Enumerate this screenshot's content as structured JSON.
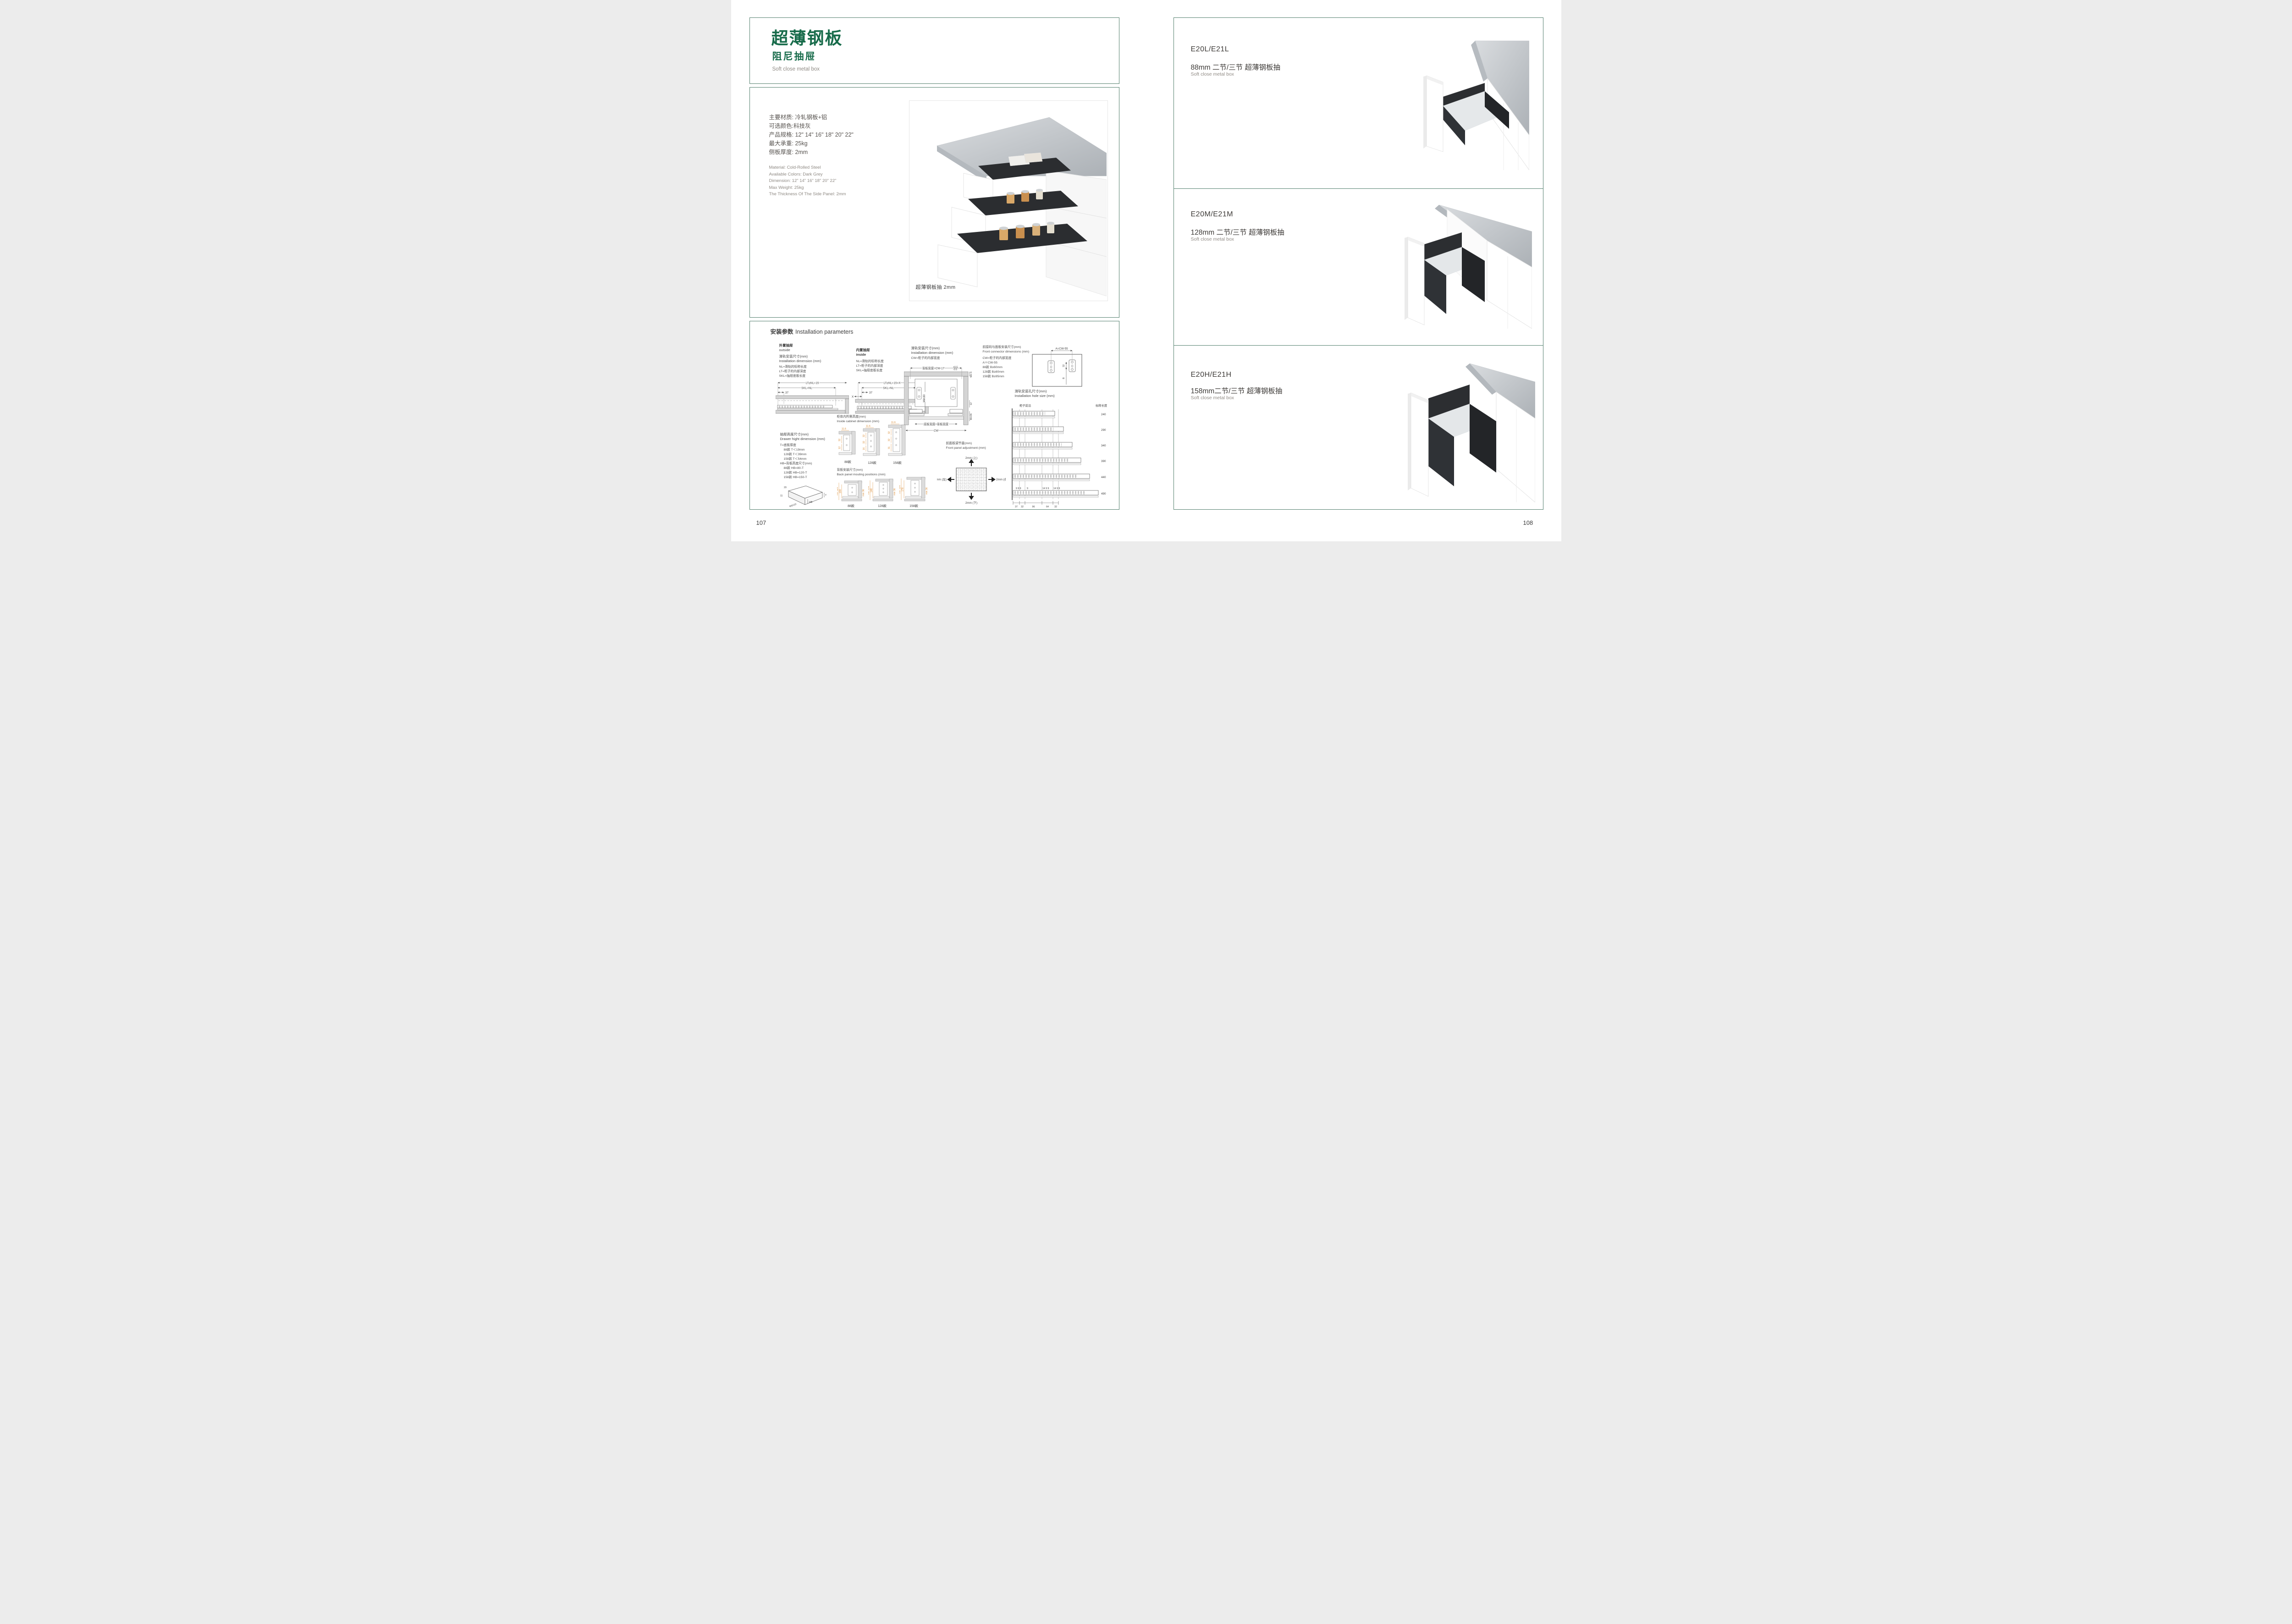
{
  "page": {
    "left_number": "107",
    "right_number": "108"
  },
  "left_page": {
    "title_cn": "超薄钢板",
    "subtitle_cn": "阻尼抽屉",
    "subtitle_en": "Soft close metal box",
    "specs_cn": [
      "主要材质: 冷轧钢板+铝",
      "可选颜色:科技灰",
      "产品规格: 12\" 14\" 16\" 18\" 20\" 22\"",
      "最大承重: 25kg",
      "侧板厚度: 2mm"
    ],
    "specs_en": [
      "Material: Cold-Rolled Steel",
      "Available Colors: Dark Grey",
      "Dimension: 12\" 14\" 16\" 18\" 20\" 22\"",
      "Max Weight: 25kg",
      "The Thickness Of The Side Panel: 2mm"
    ],
    "photo_caption": "超薄钢板抽 2mm"
  },
  "install": {
    "header_cn": "安装参数",
    "header_en": "Installation parameters",
    "outside": {
      "label_cn": "外置抽屉",
      "label_en": "outside",
      "title_cn": "滑轨安装尺寸(mm)",
      "title_en": "Installation dimension (mm)",
      "legend": [
        "NL=滑轨的标称长度",
        "LT=柜子的内部深度",
        "SKL=抽屉底板长度"
      ],
      "dim_top": "LT≥NL+15",
      "dim_mid": "SKL=NL",
      "dim_offset": "37"
    },
    "inside": {
      "label_cn": "内置抽屉",
      "label_en": "inside",
      "legend": [
        "NL=滑轨的标称长度",
        "LT=柜子的内部深度",
        "SKL=抽屉底板长度"
      ],
      "dim_top": "LT≥NL+15+X",
      "dim_mid": "SKL=NL",
      "dim_offset": "37",
      "dim_x": "X"
    },
    "cw": {
      "title_cn": "滑轨安装尺寸(mm)",
      "title_en": "Installation dimension (mm)",
      "legend": "CW=柜子的内部宽度",
      "dim_back_width": "背板宽度=CW-17",
      "tol_plus": "+0.5",
      "tol_minus": "-0.5",
      "dim_min6": "Min 6",
      "dim_min30": "Min30",
      "dim_12": "12",
      "dim_min36": "Min36",
      "dim_bottom": "底板宽度=背板宽度",
      "dim_cw": "CW"
    },
    "connector": {
      "title_cn": "前接码与面板安装尺寸(mm)",
      "title_en": "Front connector  dimensions (mm)",
      "legend_cw": "CW=柜子的内部宽度",
      "legend_a": "A＝CW-55",
      "legend_rows": [
        "88款    B≥60mm",
        "128款  B≥80mm",
        "158款  B≥95mm"
      ],
      "dim_a": "A=CW-55",
      "dim_32": "32",
      "dim_b": "B"
    },
    "hole": {
      "title_cn": "滑轨安装孔尺寸(mm)",
      "title_en": "Installation hole size (mm)",
      "front_edge": "柜子前沿",
      "col_header": "标称长度",
      "lengths": [
        "240",
        "290",
        "340",
        "390",
        "440",
        "490"
      ],
      "top_dims": [
        "9 9 9",
        "9",
        "14 9 9",
        "14 9 9"
      ],
      "bottom_dims": [
        "37",
        "32",
        "96",
        "64",
        "32"
      ]
    },
    "height": {
      "title_cn": "抽屉高度尺寸(mm)",
      "title_en": "Drawer hight dimension (mm)",
      "lines": [
        "T=底板厚度",
        "88款   T＜19mm",
        "128款  T＜39mm",
        "158款  T＜54mm",
        "HB=背板高度尺寸(mm)",
        "88款   HB=80-T",
        "128款 HB=120-T",
        "158款 HB=150-T"
      ],
      "sketch_20": "20",
      "sketch_11": "11",
      "sketch_screw": "Φ6X10",
      "sketch_hb": "HB",
      "sketch_t": "T"
    },
    "cabinet_height": {
      "title_cn": "柜体内所需高度(mm)",
      "title_en": "Inside cabinet dimension (mm)",
      "variants": [
        {
          "label": "88款",
          "d1": "11.6",
          "d2": "32",
          "d3": "12"
        },
        {
          "label": "128款",
          "d1": "11.6",
          "d2": "32",
          "d3": "32",
          "d4": "16"
        },
        {
          "label": "158款",
          "d1": "11.6",
          "d2": "32",
          "d3": "32",
          "d4": "31"
        }
      ]
    },
    "back_panel": {
      "title_cn": "背板安装尺寸(mm)",
      "title_en": "Back panel mouting positions (mm)",
      "variants": [
        {
          "label": "88款",
          "min": "min 114",
          "h": "108",
          "min36": "min 36"
        },
        {
          "label": "128款",
          "min": "min 154",
          "h": "148",
          "min36": "min 36"
        },
        {
          "label": "158款",
          "min": "min 184",
          "h": "178",
          "min36": "min 36"
        }
      ]
    },
    "adjust": {
      "title_cn": "前面板调节量(mm)",
      "title_en": "Front panel adjustment (mm)",
      "up": "2mm (上)",
      "down": "2mm (下)",
      "left": "2mm (左)",
      "right": "2mm (右)"
    }
  },
  "products": [
    {
      "model": "E20L/E21L",
      "size_cn": "88mm 二节/三节 超薄钢板抽",
      "desc_en": "Soft close metal box"
    },
    {
      "model": "E20M/E21M",
      "size_cn": "128mm 二节/三节 超薄钢板抽",
      "desc_en": "Soft close metal box"
    },
    {
      "model": "E20H/E21H",
      "size_cn": "158mm二节/三节 超薄钢板抽",
      "desc_en": "Soft close metal box"
    }
  ]
}
